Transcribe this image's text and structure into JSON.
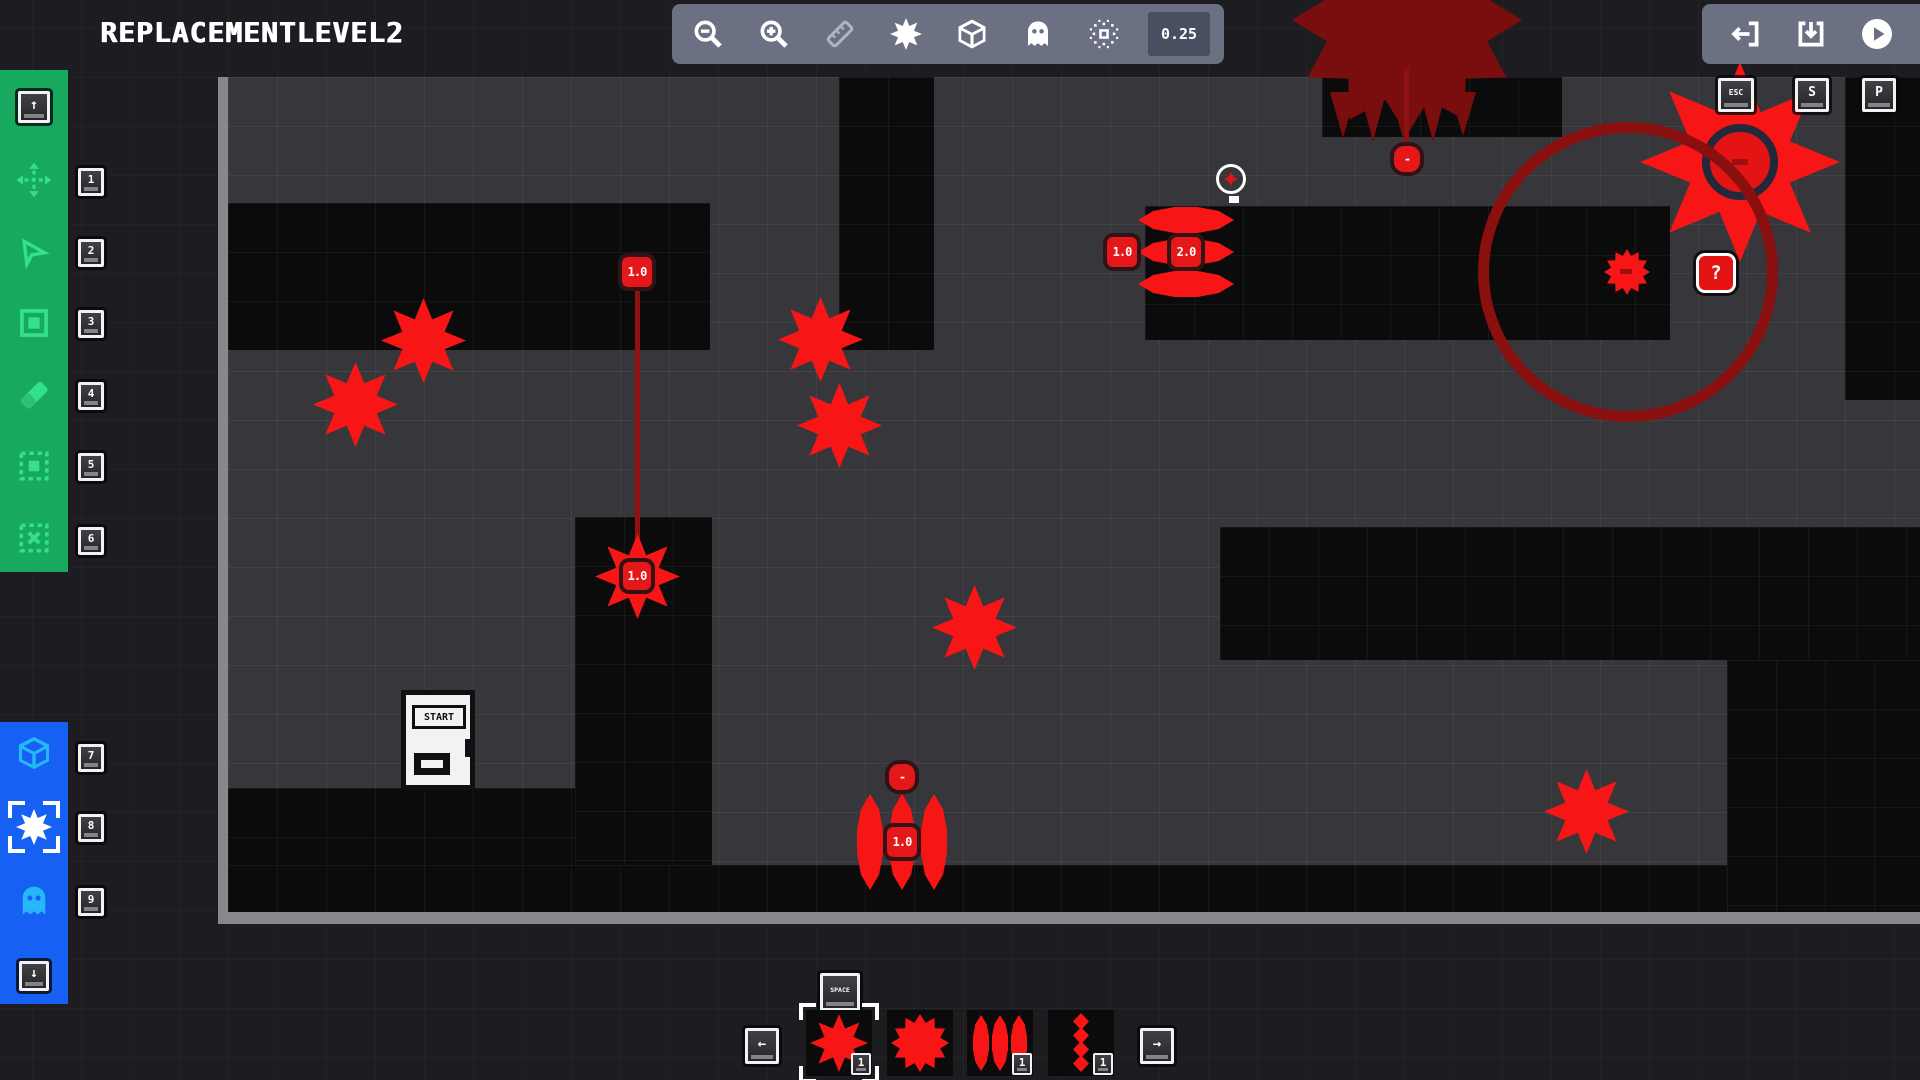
{
  "title": "REPLACEMENTLEVEL2",
  "toolbar": {
    "snap_value": "0.25"
  },
  "sidebar": {
    "up_hint_glyph": "↑",
    "down_hint_glyph": "↓",
    "tool_keys": [
      "1",
      "2",
      "3",
      "4",
      "5",
      "6"
    ],
    "entity_keys": [
      "7",
      "8",
      "9"
    ]
  },
  "canvas": {
    "hotkeys": [
      "ESC",
      "S",
      "P"
    ],
    "space_key_label": "SPACE",
    "door_label": "START",
    "values": {
      "mover_speed": "1.0",
      "mover_star": "1.0",
      "hmissile_left": "1.0",
      "hmissile_center": "2.0",
      "vmissile_top": "-",
      "vmissile_center": "1.0",
      "cloud_node": "-",
      "bigstar_core": "-",
      "question_box": "?"
    }
  },
  "palette": {
    "prev_glyph": "←",
    "next_glyph": "→",
    "items": [
      {
        "badge": "1"
      },
      {
        "badge": ""
      },
      {
        "badge": "1"
      },
      {
        "badge": "1"
      }
    ]
  },
  "colors": {
    "accent_red": "#f71515",
    "dark_red": "#7a0d0d",
    "tool_green": "#17a95e",
    "entity_blue": "#1661f4",
    "toolbar_gray": "#6b7183"
  }
}
